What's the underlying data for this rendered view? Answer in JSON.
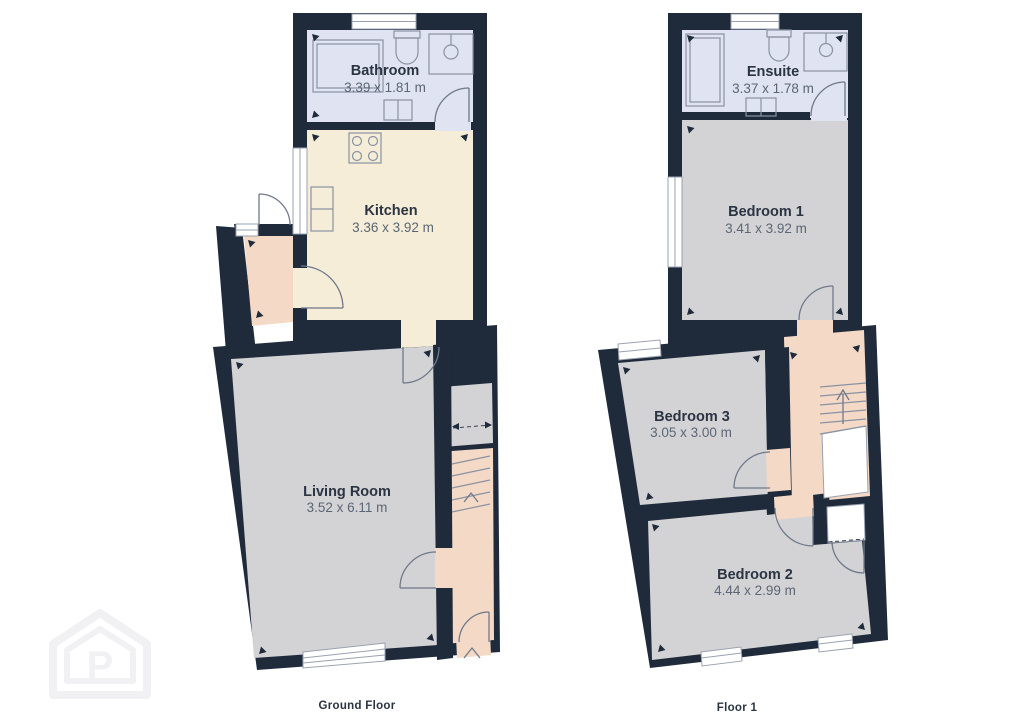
{
  "colors": {
    "wall": "#1f2b3b",
    "room_gray": "#d3d3d5",
    "kitchen_cream": "#f5edd7",
    "bathroom_blue": "#dfe3f2",
    "hall_pink": "#f4d9c6",
    "window_white": "#ffffff",
    "name_text": "#2b3442",
    "dims_text": "#5b6675",
    "watermark": "#f1f1f3"
  },
  "floors": [
    {
      "label": "Ground Floor",
      "rooms": [
        {
          "name": "Bathroom",
          "dimensions": "3.39 x 1.81 m"
        },
        {
          "name": "Kitchen",
          "dimensions": "3.36 x 3.92 m"
        },
        {
          "name": "Living Room",
          "dimensions": "3.52 x 6.11 m"
        }
      ]
    },
    {
      "label": "Floor 1",
      "rooms": [
        {
          "name": "Ensuite",
          "dimensions": "3.37 x 1.78 m"
        },
        {
          "name": "Bedroom 1",
          "dimensions": "3.41 x 3.92 m"
        },
        {
          "name": "Bedroom 3",
          "dimensions": "3.05 x 3.00 m"
        },
        {
          "name": "Bedroom 2",
          "dimensions": "4.44 x 2.99 m"
        }
      ]
    }
  ],
  "watermark": {
    "icon": "house-p-logo",
    "letter": "P"
  }
}
